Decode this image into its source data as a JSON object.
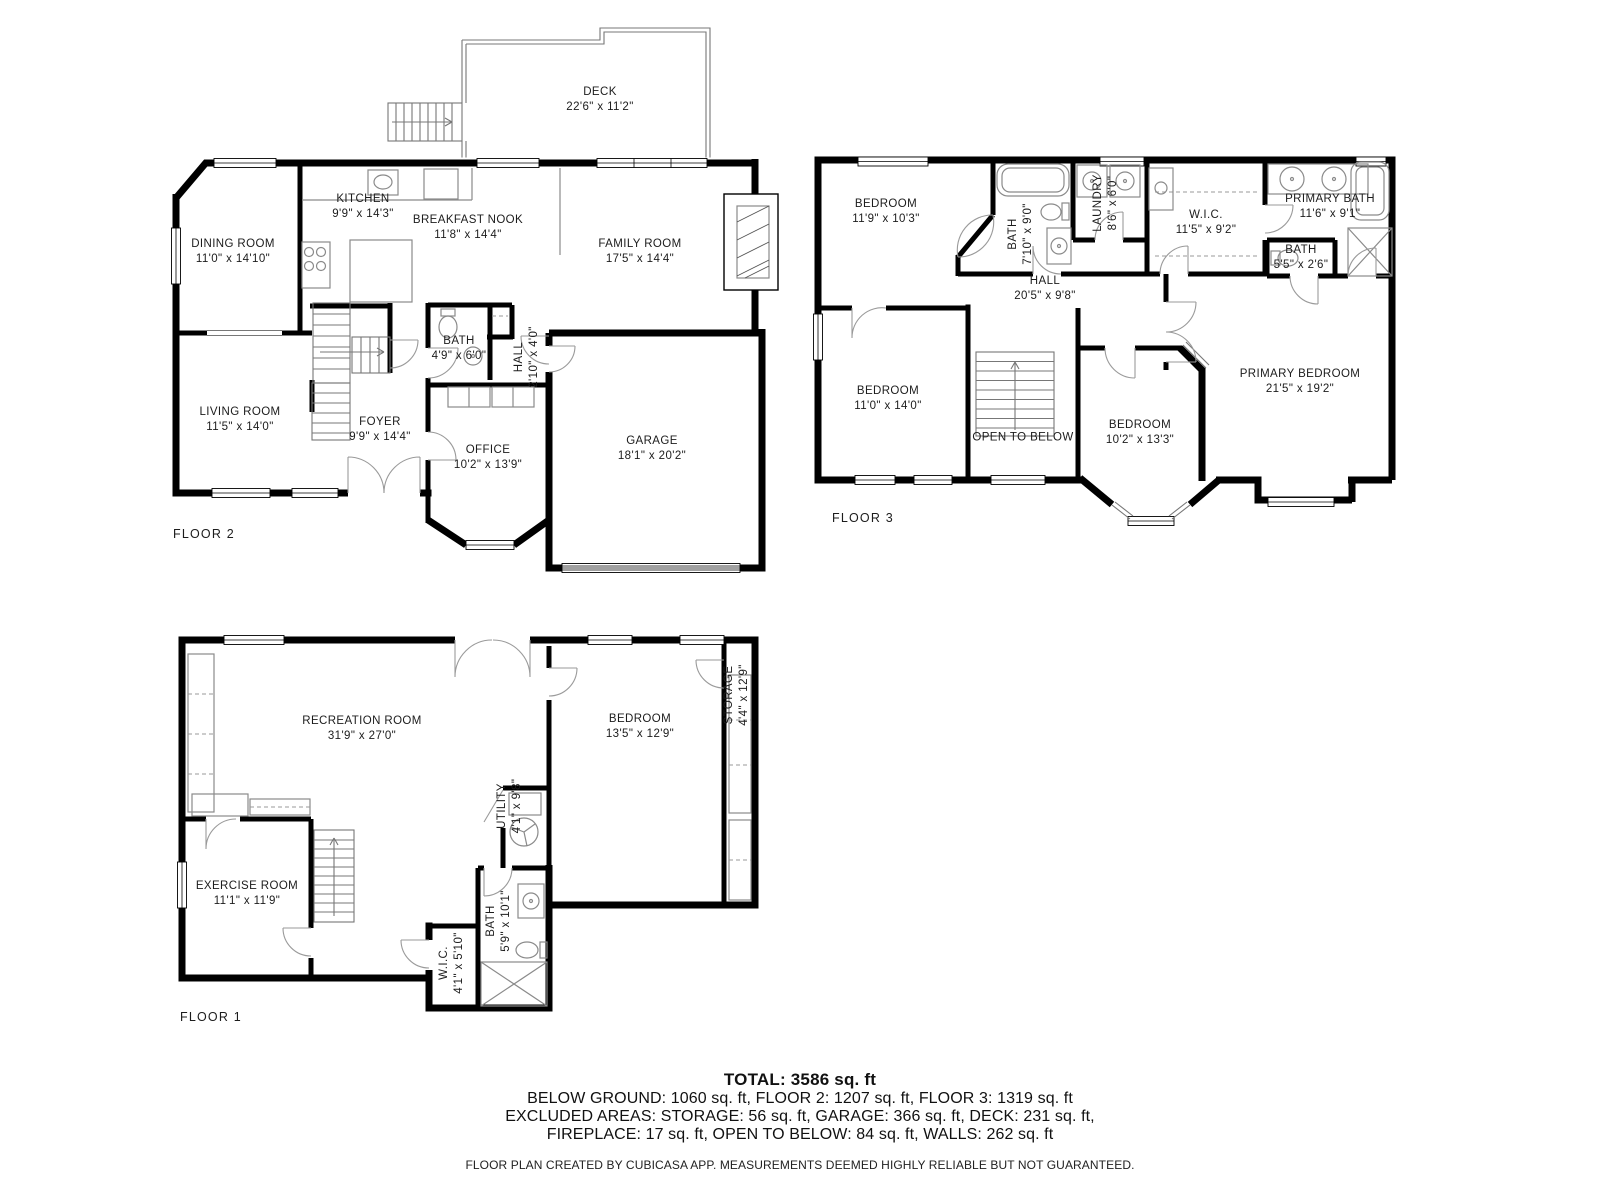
{
  "floors": [
    {
      "id": "floor2",
      "label": "FLOOR 2",
      "rooms": [
        {
          "name": "DECK",
          "dims": "22'6\" x 11'2\""
        },
        {
          "name": "KITCHEN",
          "dims": "9'9\" x 14'3\""
        },
        {
          "name": "BREAKFAST NOOK",
          "dims": "11'8\" x 14'4\""
        },
        {
          "name": "DINING ROOM",
          "dims": "11'0\" x 14'10\""
        },
        {
          "name": "FAMILY ROOM",
          "dims": "17'5\" x 14'4\""
        },
        {
          "name": "LIVING ROOM",
          "dims": "11'5\" x 14'0\""
        },
        {
          "name": "FOYER",
          "dims": "9'9\" x 14'4\""
        },
        {
          "name": "BATH",
          "dims": "4'9\" x 6'0\""
        },
        {
          "name": "HALL",
          "dims": "2'10\" x 4'0\""
        },
        {
          "name": "OFFICE",
          "dims": "10'2\" x 13'9\""
        },
        {
          "name": "GARAGE",
          "dims": "18'1\" x 20'2\""
        }
      ]
    },
    {
      "id": "floor3",
      "label": "FLOOR 3",
      "rooms": [
        {
          "name": "BEDROOM",
          "dims": "11'9\" x 10'3\""
        },
        {
          "name": "BATH",
          "dims": "7'10\" x 9'0\""
        },
        {
          "name": "LAUNDRY",
          "dims": "8'6\" x 6'0\""
        },
        {
          "name": "W.I.C.",
          "dims": "11'5\" x 9'2\""
        },
        {
          "name": "PRIMARY BATH",
          "dims": "11'6\" x 9'1\""
        },
        {
          "name": "BATH",
          "dims": "5'5\" x 2'6\""
        },
        {
          "name": "HALL",
          "dims": "20'5\" x 9'8\""
        },
        {
          "name": "BEDROOM",
          "dims": "11'0\" x 14'0\""
        },
        {
          "name": "OPEN TO BELOW",
          "dims": ""
        },
        {
          "name": "BEDROOM",
          "dims": "10'2\" x 13'3\""
        },
        {
          "name": "PRIMARY BEDROOM",
          "dims": "21'5\" x 19'2\""
        }
      ]
    },
    {
      "id": "floor1",
      "label": "FLOOR 1",
      "rooms": [
        {
          "name": "RECREATION ROOM",
          "dims": "31'9\" x 27'0\""
        },
        {
          "name": "BEDROOM",
          "dims": "13'5\" x 12'9\""
        },
        {
          "name": "STORAGE",
          "dims": "4'4\" x 12'9\""
        },
        {
          "name": "UTILITY",
          "dims": "4'1\" x 9'8\""
        },
        {
          "name": "EXERCISE ROOM",
          "dims": "11'1\" x 11'9\""
        },
        {
          "name": "W.I.C.",
          "dims": "4'1\" x 5'10\""
        },
        {
          "name": "BATH",
          "dims": "5'9\" x 10'1\""
        }
      ]
    }
  ],
  "summary": {
    "total": "TOTAL: 3586 sq. ft",
    "line1": "BELOW GROUND: 1060 sq. ft, FLOOR 2: 1207 sq. ft, FLOOR 3: 1319 sq. ft",
    "line2": "EXCLUDED AREAS: STORAGE: 56 sq. ft, GARAGE: 366 sq. ft, DECK: 231 sq. ft,",
    "line3": "FIREPLACE: 17 sq. ft, OPEN TO BELOW: 84 sq. ft, WALLS: 262 sq. ft",
    "footer": "FLOOR PLAN CREATED BY CUBICASA APP. MEASUREMENTS DEEMED HIGHLY RELIABLE BUT NOT GUARANTEED."
  }
}
